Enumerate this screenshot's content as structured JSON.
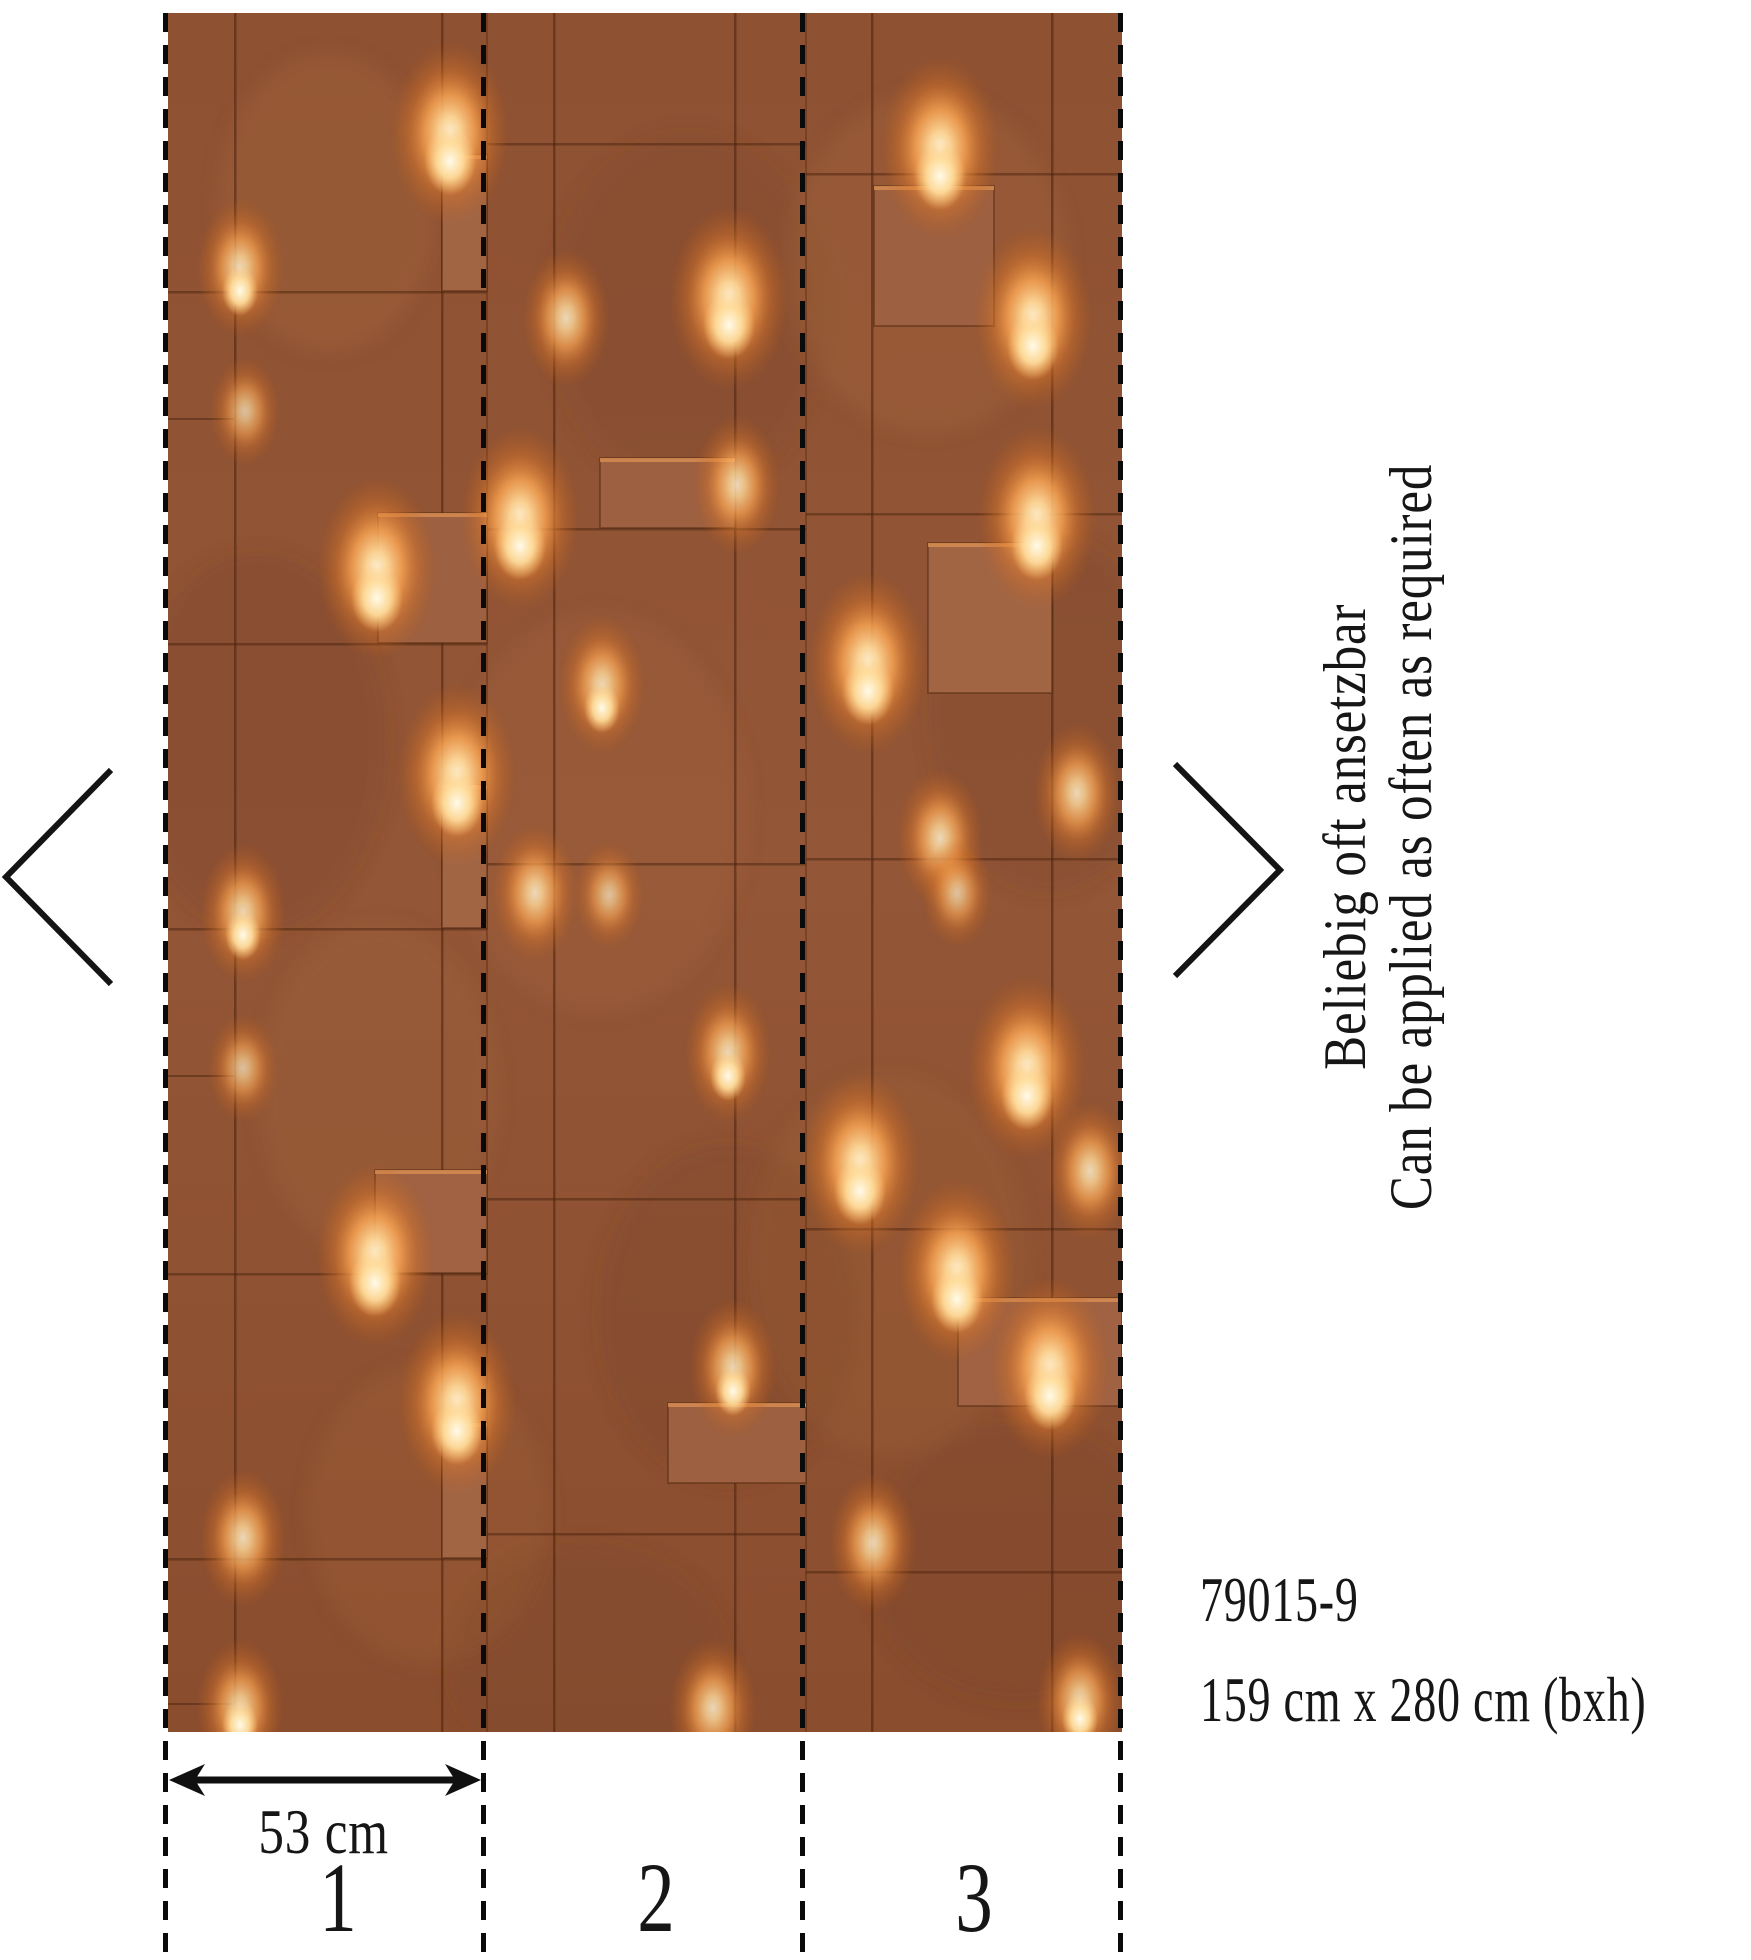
{
  "side_annotation": {
    "line_de": "Beliebig oft ansetzbar",
    "line_en": "Can be applied as often as required"
  },
  "product": {
    "article_number": "79015-9",
    "dimensions": "159 cm x 280 cm (bxh)"
  },
  "measurement": {
    "strip_width_label": "53 cm"
  },
  "strip_numbers": [
    "1",
    "2",
    "3"
  ],
  "icons": {
    "chevron_left": "‹",
    "chevron_right": "›",
    "width_arrow": "↔"
  },
  "colors": {
    "background": "#ffffff",
    "text": "#161616",
    "dash_line": "#0a0a0a",
    "rust_base": "#8e5132",
    "rust_dark": "#7a4325",
    "rust_light": "#a26544",
    "seam": "#4a230e",
    "glow_core": "#fff2d4",
    "glow_mid": "#fca653",
    "glow_deep": "#e07a2a"
  }
}
